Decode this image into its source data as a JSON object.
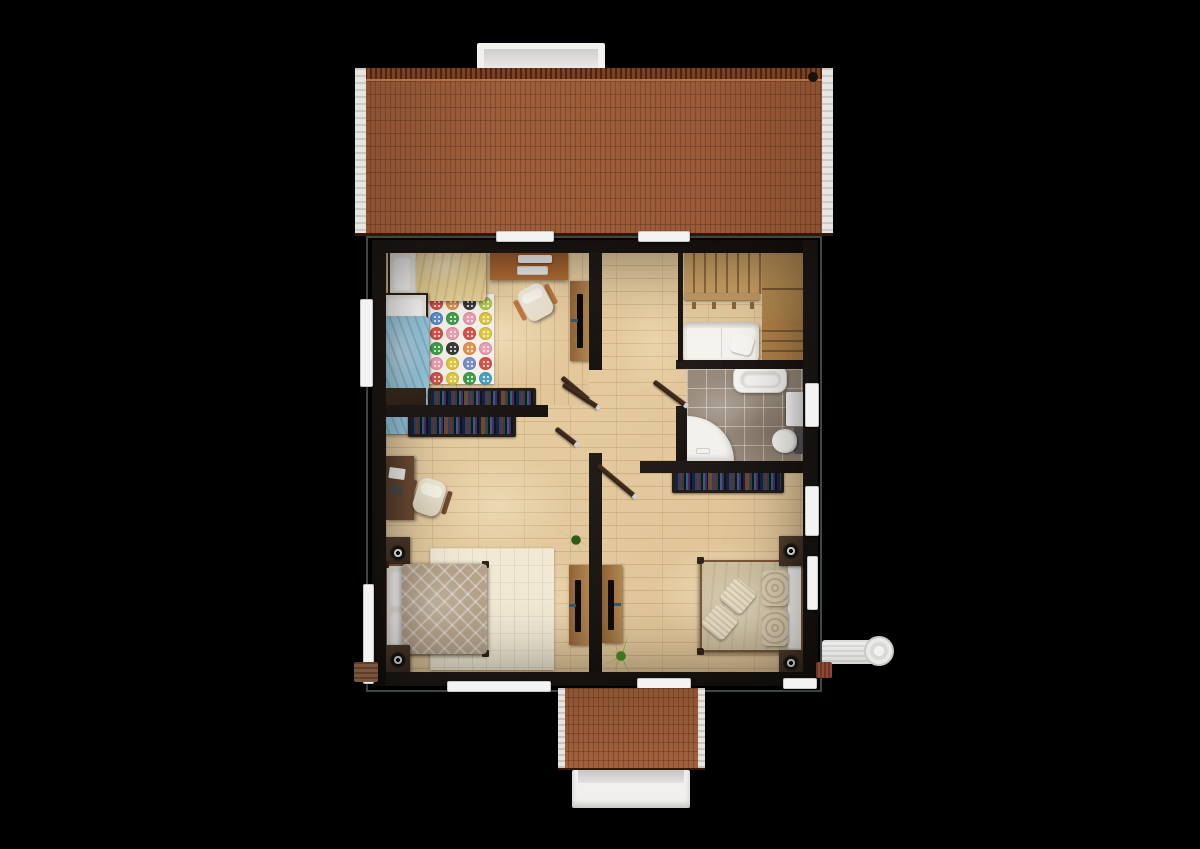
{
  "palette": {
    "bg": "#000000",
    "wall": "#1b1715",
    "roof": "#96583a",
    "roof-ridge": "#5d2c18",
    "floor": "#e6cda2",
    "tile": "#97897b",
    "stair": "#c9a065",
    "blanket-yellow": "#e7d096",
    "blanket-blue": "#99c8dd",
    "duvet-left": "#b4a28b",
    "duvet-right": "#cdbf9f",
    "rug-white": "#f4f1ea",
    "rug-cream": "#f1e9d4",
    "plant-dark": "#3c7d22",
    "plant-light": "#7cc02d",
    "btn-red": "#d9534a",
    "btn-orange": "#e8954f",
    "btn-charcoal": "#3d3b38",
    "btn-lime": "#b5cc51",
    "btn-blue": "#5b8fd4",
    "btn-green": "#43a04c",
    "btn-pink": "#ef9fb0",
    "btn-yellow": "#e3c93f",
    "btn-periwinkle": "#7b8fd0",
    "btn-teal": "#46a3c4"
  },
  "rug": {
    "rows": 6,
    "cols": 4,
    "buttons": [
      "red",
      "orange",
      "charcoal",
      "lime",
      "blue",
      "green",
      "pink",
      "yellow",
      "red",
      "pink",
      "red",
      "yellow",
      "green",
      "charcoal",
      "orange",
      "pink",
      "pink",
      "yellow",
      "periwinkle",
      "red",
      "red",
      "yellow",
      "green",
      "teal"
    ]
  },
  "scene": {
    "view": "top-down 3d floor plan render",
    "rooms": {
      "kids_bedroom": [
        "single-bed-yellow-blanket",
        "single-bed-blue-blanket",
        "button-rug",
        "desk",
        "monitor",
        "keyboard",
        "office-chair",
        "tv-cabinet",
        "bookshelf",
        "storage-cube"
      ],
      "hallway": [
        "staircase-upper-flight",
        "staircase-landing",
        "staircase-lower-flight",
        "railing",
        "white-bench-sofa"
      ],
      "bathroom": [
        "bathtub",
        "corner-shower",
        "toilet",
        "cabinet",
        "door"
      ],
      "study_bedroom_left": [
        "desk",
        "laptop",
        "office-chair",
        "bookshelf",
        "double-bed-patterned-duvet",
        "pillows",
        "nightstand-top",
        "nightstand-bottom",
        "cream-rug",
        "tv-cabinet",
        "potted-plant"
      ],
      "bedroom_right": [
        "double-bed-khaki-duvet",
        "damask-pillows",
        "cushions",
        "nightstand-top",
        "nightstand-bottom",
        "tv-cabinet",
        "fern-plant",
        "bookshelf"
      ]
    },
    "exterior": [
      "main-roof",
      "chimney",
      "roof-vent",
      "porch-roof",
      "porch-steps",
      "window-sills",
      "ac-unit-right",
      "ac-unit-left"
    ]
  }
}
